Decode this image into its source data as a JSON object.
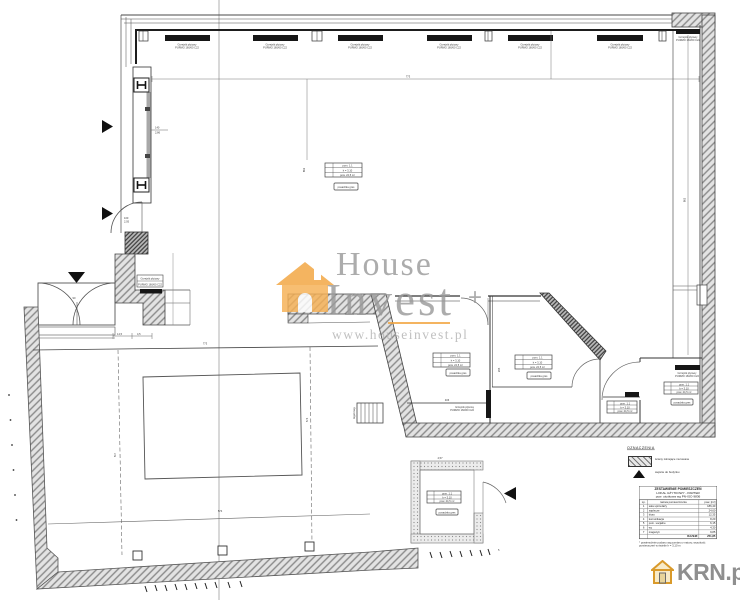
{
  "watermark": {
    "brand_top": "House",
    "brand_bottom": "Invest",
    "plus": "+",
    "url": "www.houseinvest.pl"
  },
  "krn": {
    "label": "KRN.pl"
  },
  "legend": {
    "title": "OZNACZENIA",
    "wall_label": "ściany istniejące murowane",
    "entry_label": "wejście do budynku"
  },
  "schedule": {
    "header1": "ZESTAWIENIE POMIESZCZEŃ",
    "header2": "LOKAL UŻYTKOWY - PARTER",
    "header3": "pow. użytkowa wg PN-ISO 9836",
    "col_lp": "Lp.",
    "col_name": "nazwa pomieszczenia",
    "col_area": "pow. [m²]",
    "rows": [
      [
        "1",
        "sala sprzedaży",
        "186,40"
      ],
      [
        "2",
        "zaplecze",
        "24,60"
      ],
      [
        "3",
        "biuro",
        "12,35"
      ],
      [
        "4",
        "komunikacja",
        "8,20"
      ],
      [
        "5",
        "pom. socjalne",
        "6,15"
      ],
      [
        "6",
        "wc",
        "4,30"
      ],
      [
        "7",
        "magazyn",
        "9,85"
      ],
      [
        "",
        "",
        ""
      ]
    ],
    "total_label": "RAZEM:",
    "total_value": "251,85",
    "note": "* powierzchnie podano wg pomiaru z natury; wysokość pomieszczeń w świetle h = 3,10 m"
  },
  "labels": {
    "radiator": {
      "l1": "Grzejnik płytowy",
      "l2": "PURMO 160/60 C22"
    },
    "room_table": {
      "r1": "pom. 1.1",
      "r2": "h = 3,10",
      "r3": "pow. 24,5 m²",
      "plate": "posadzka gres"
    },
    "rack": "regał mag."
  },
  "dims": {
    "top": "773",
    "shaft": "862",
    "hall_v": "862",
    "win": "140",
    "win2": "2,86",
    "door": "100",
    "door2": "2,05",
    "entry": "90",
    "step1": "14,5",
    "step2": "4,5",
    "big_top": "773",
    "big_left": "517",
    "big_right": "574",
    "big_bottom": "574",
    "room_w": "406",
    "room2": "295",
    "shed": "4,57",
    "five": "5"
  }
}
